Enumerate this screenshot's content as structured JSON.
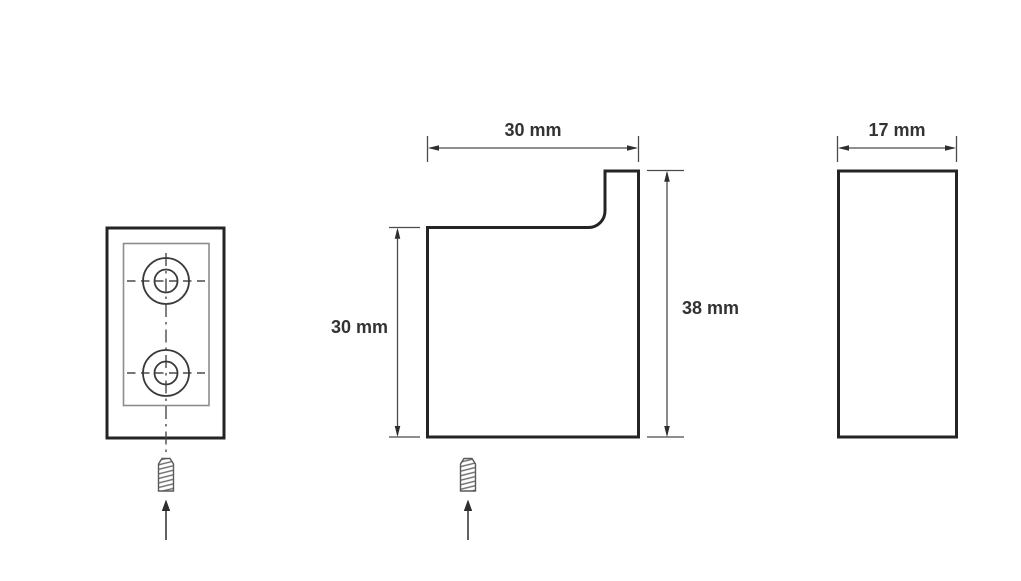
{
  "page": {
    "background": "#ffffff"
  },
  "drawing": {
    "type": "technical dimension drawing of wall hook (three views)",
    "colors": {
      "outline": "#242424",
      "thin_line": "#4a4a4a",
      "inner_line": "#8d8d8d",
      "text": "#333333"
    },
    "labels": {
      "top_width": "30 mm",
      "body_height": "30 mm",
      "total_height": "38 mm",
      "depth": "17 mm"
    },
    "icons": {
      "screw": "screw-icon",
      "mounting_arrow": "arrow-up-icon"
    }
  }
}
